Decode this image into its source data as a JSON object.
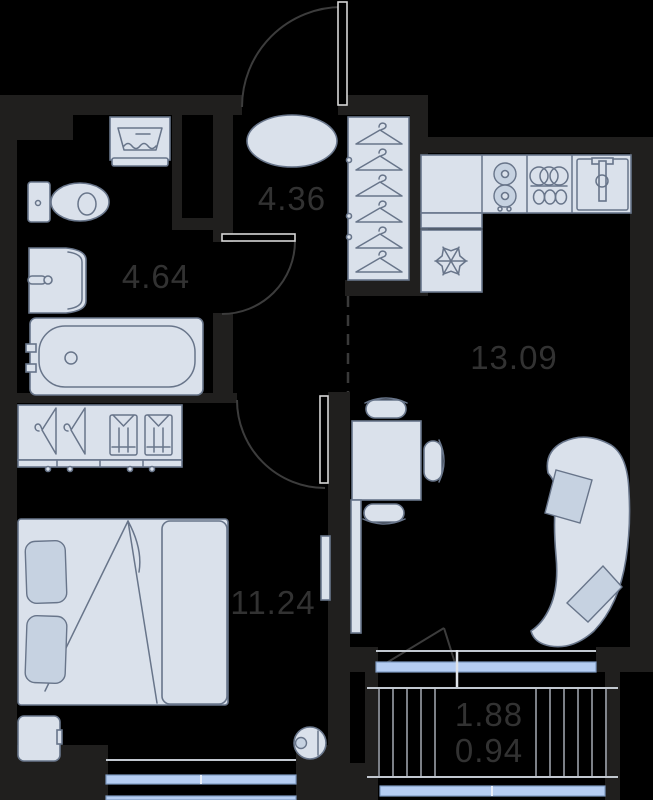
{
  "plan": {
    "type": "apartment-floor-plan",
    "rooms": [
      {
        "name": "bathroom",
        "area_label": "4.64"
      },
      {
        "name": "hallway",
        "area_label": "4.36"
      },
      {
        "name": "kitchen-living-room",
        "area_label": "13.09"
      },
      {
        "name": "bedroom",
        "area_label": "11.24"
      },
      {
        "name": "balcony",
        "area_label": "1.88",
        "reduced_area_label": "0.94"
      }
    ],
    "furniture_icons": [
      "washing-machine-icon",
      "toilet-icon",
      "bathroom-sink-icon",
      "bathtub-icon",
      "pouf-icon",
      "hanger-icon",
      "kitchen-counter-icon",
      "stove-burners-icon",
      "dish-rack-icon",
      "kitchen-sink-icon",
      "fridge-snowflake-icon",
      "dining-table-icon",
      "dining-chair-icon",
      "curved-sofa-icon",
      "pillow-icon",
      "tv-console-icon",
      "wardrobe-icon",
      "folded-shirt-icon",
      "double-bed-icon",
      "nightstand-icon",
      "robot-vacuum-icon"
    ],
    "colors": {
      "background": "#000000",
      "wall": "#201f1e",
      "furniture_fill": "#dae1eb",
      "furniture_stroke": "#68758a",
      "pillow_fill": "#c6d2e1",
      "glazing_fill": "#b5cdf2",
      "glazing_stroke": "#7d99c0",
      "label_text": "#323232",
      "door_swing": "#3c3c3c",
      "door_leaf": "#d6d6d6",
      "balcony_hatch": "#9ba1a9",
      "sill_line": "#c2c8d0"
    }
  }
}
